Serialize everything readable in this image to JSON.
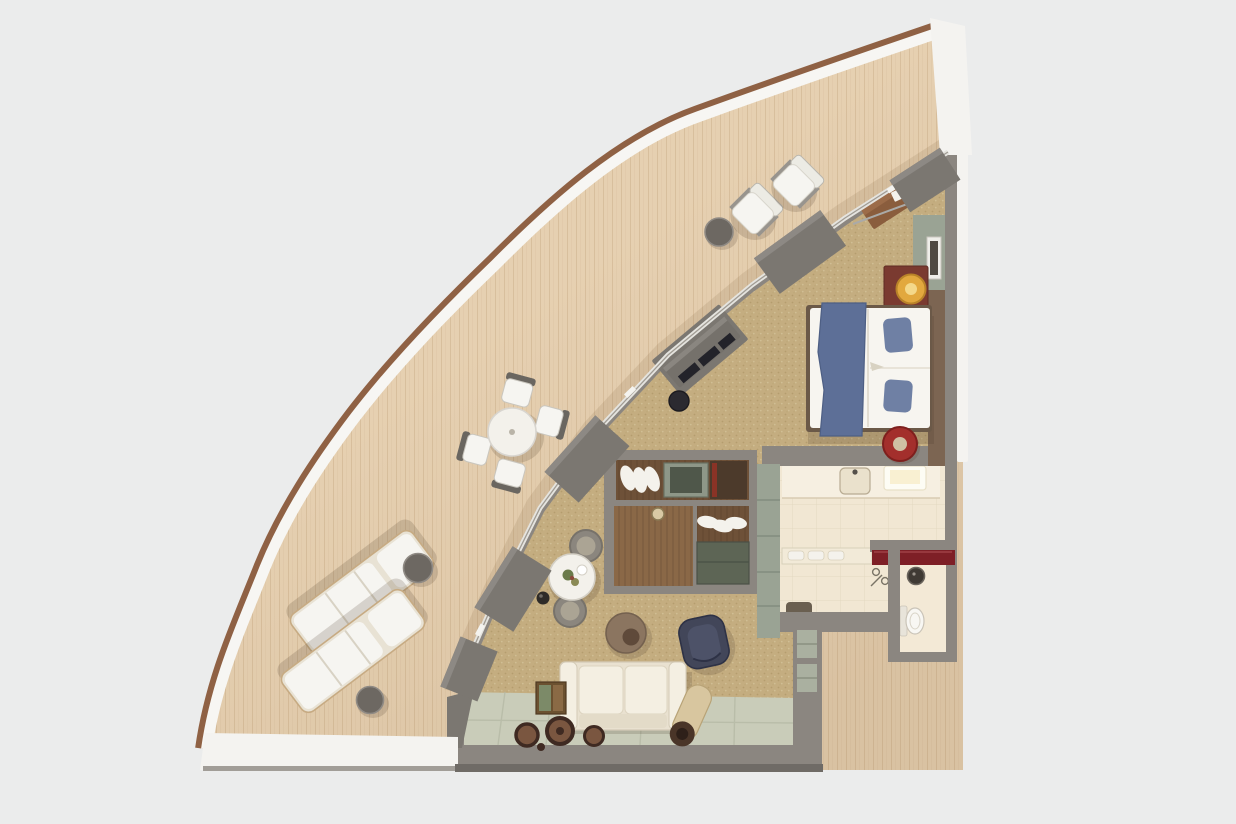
{
  "meta": {
    "scene": "3D top-down rendering of a hotel / cruise-ship suite floor plan",
    "shape": "quarter-fan suite with large curved private balcony, no text labels visible"
  },
  "colors": {
    "background": "#ebecec",
    "deck_wood": "#e6d0b1",
    "deck_plank": "#c9ae8a",
    "rail_white": "#f7f6f3",
    "rail_cap": "#8f6144",
    "wall_gray": "#8b8680",
    "wall_dark": "#7b7771",
    "exterior_white": "#f4f3f0",
    "carpet": "#c4ad80",
    "carpet_speck_dark": "#a8905e",
    "carpet_speck_light": "#dbcca4",
    "glass_line": "#e5e4df",
    "glass_frame": "#a19c94",
    "bath_floor": "#f1e7d3",
    "bath_tile": "#e0d4bb",
    "vanity_cream": "#f6efe1",
    "entry_tile": "#c9ccb9",
    "entry_tile_line": "#b4b8a4",
    "cabinet_sage": "#9aa394",
    "cabinet_dark_sage": "#5d6555",
    "closet_wood": "#6e5138",
    "closet_wood_light": "#8a6847",
    "shirt_white": "#f4f2ec",
    "counter_red": "#7e1f26",
    "nightstand_red": "#7a3a30",
    "lamp_gold": "#e2a83e",
    "lamp_gold_light": "#f4d88a",
    "stool_red": "#a32f2c",
    "stool_top": "#cfc0a4",
    "headboard": "#7c6552",
    "bed_white": "#f7f5f0",
    "bed_frame": "#6b5948",
    "throw_blue": "#5d6f97",
    "pillow_blue": "#6f80a4",
    "tv_dark": "#23232a",
    "console_gray": "#75716b",
    "sofa_cream": "#e9e1d0",
    "sofa_cushion": "#f4efe2",
    "armchair_navy": "#424659",
    "pouf_brown": "#8b7560",
    "pouf_dark": "#5f4a3a",
    "bolster_tan": "#d8c69f",
    "bolster_end": "#4a3528",
    "table_white": "#f3f1eb",
    "chair_gray": "#8b867e",
    "chair_seat": "#aba494",
    "side_table_wood": "#6b5130",
    "picture_green": "#7c8a68",
    "toilet_white": "#f8f7f3",
    "sink_dark": "#3f3a34",
    "mat_dark": "#6a5f50",
    "medallion_dark": "#3f2a22",
    "medallion_mid": "#7a5640",
    "furniture_white": "#f6f5f1",
    "shadow_color": "rgba(70,58,40,0.18)"
  },
  "rooms": [
    {
      "id": "balcony",
      "name": "curved private balcony with teak deck"
    },
    {
      "id": "bedroom",
      "name": "bedroom"
    },
    {
      "id": "living-room",
      "name": "living room lounge"
    },
    {
      "id": "wardrobe-hall",
      "name": "wardrobe hallway"
    },
    {
      "id": "bathroom",
      "name": "bathroom"
    },
    {
      "id": "toilet-room",
      "name": "separate toilet room"
    },
    {
      "id": "entry",
      "name": "entry with tiled floor"
    }
  ],
  "furniture": {
    "balcony": [
      "lounge armchair",
      "lounge armchair",
      "round side table",
      "round dining table",
      "dining chair",
      "dining chair",
      "dining chair",
      "dining chair",
      "sun lounger",
      "sun lounger",
      "round side table",
      "round side table"
    ],
    "bedroom": [
      "double bed with blue throw and two blue pillows",
      "upholstered headboard wall",
      "red nightstand with gold table lamp",
      "round red ottoman",
      "framed wall art",
      "angled luggage bench",
      "angled tv console",
      "black round stool"
    ],
    "living_room": [
      "round bistro table with flowers",
      "tub chair",
      "tub chair",
      "dark decorative sphere",
      "round leather pouf",
      "navy armchair",
      "three-seat cream sofa",
      "rolled bolster cushion",
      "console table with artwork",
      "floor medallions"
    ],
    "wardrobe_hall": [
      "open wardrobe with hanging shirts",
      "wardrobe with cabinet",
      "tall sage cabinet column",
      "pendant light"
    ],
    "bathroom": [
      "vanity counter with sink",
      "illuminated mirror",
      "towel shelf",
      "shower mixer",
      "dark bath mat"
    ],
    "toilet_room": [
      "dark red counter",
      "wall-hung basin",
      "toilet"
    ],
    "entry": [
      "recessed shelving niches",
      "tiled entry floor"
    ]
  }
}
